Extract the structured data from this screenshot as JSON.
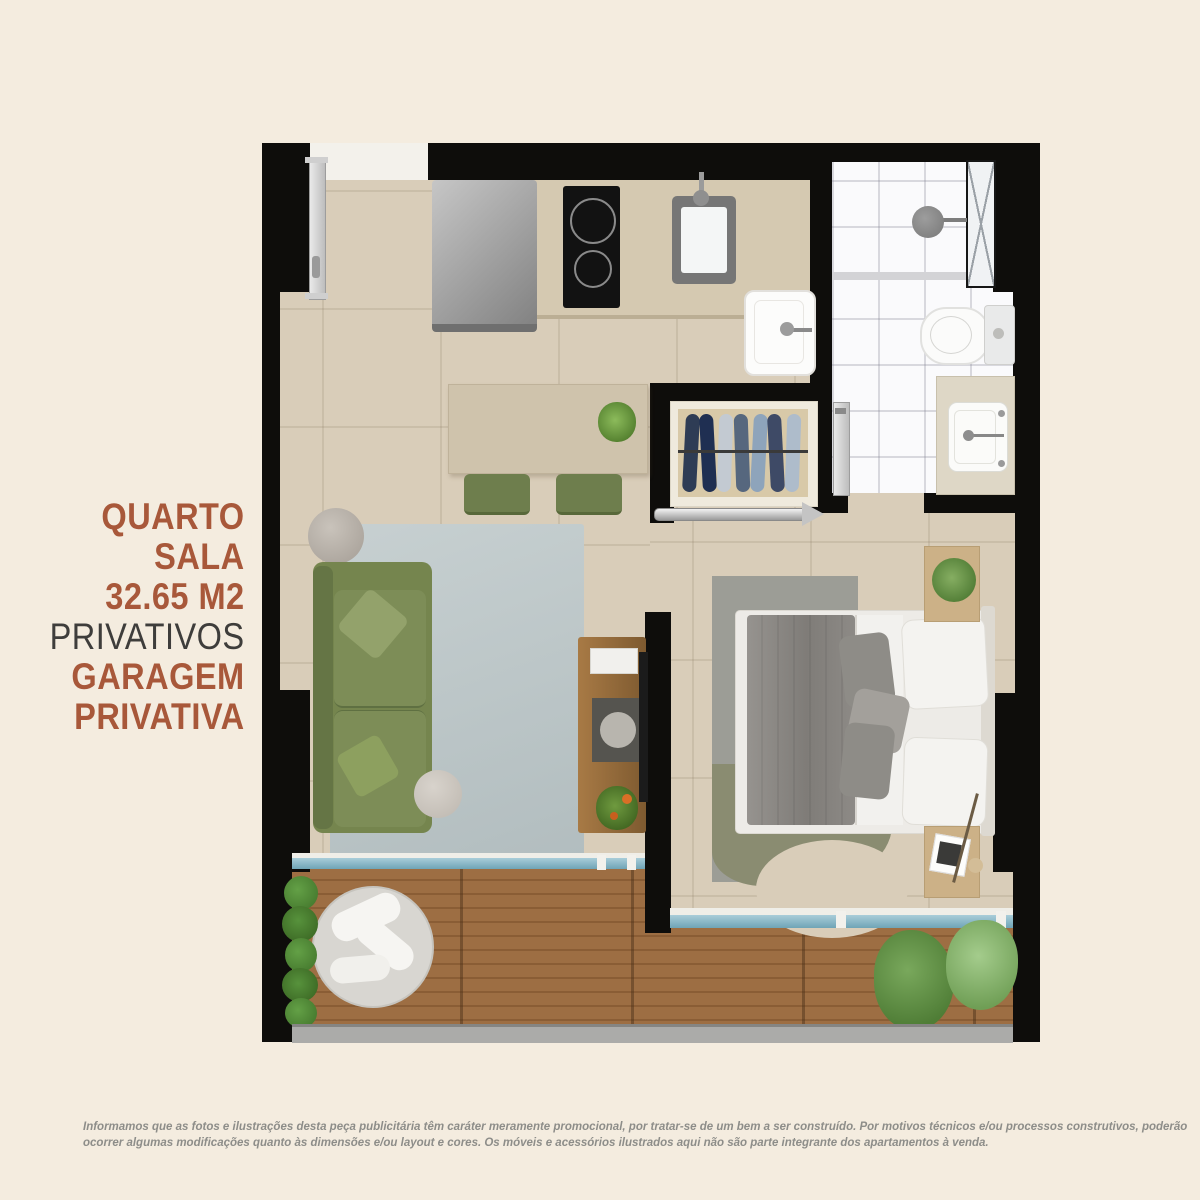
{
  "title_block": {
    "lines": [
      {
        "text": "QUARTO",
        "style": "accent"
      },
      {
        "text": "SALA",
        "style": "accent"
      },
      {
        "text": "32.65 M2",
        "style": "accent"
      },
      {
        "text": "PRIVATIVOS",
        "style": "muted"
      },
      {
        "text": "GARAGEM",
        "style": "accent"
      },
      {
        "text": "PRIVATIVA",
        "style": "accent"
      }
    ]
  },
  "disclaimer": {
    "line1": "Informamos que as fotos e ilustrações desta peça publicitária têm caráter meramente promocional, por tratar-se de um bem a ser construído. Por motivos técnicos e/ou processos construtivos, poderão",
    "line2": "ocorrer algumas modificações quanto às dimensões e/ou layout e cores. Os móveis e acessórios ilustrados aqui não são parte integrante dos apartamentos à venda."
  },
  "colors": {
    "accent_text": "#a8583a",
    "muted_text": "#3e3d3b",
    "disclaimer_text": "#8d8d89",
    "background": "#f4ecdf",
    "wall": "#0e0d0b",
    "floor_tile": "#d9cdb9",
    "bathroom_tile": "#fafafc",
    "deck_wood": "#9d6e43",
    "sliding_door_glass": "#6fa4b6",
    "sofa_green": "#75854e",
    "living_rug": "#c0c9ca",
    "bedroom_rug_gray": "#9c9d96",
    "bedroom_rug_olive": "#8a8c71"
  }
}
